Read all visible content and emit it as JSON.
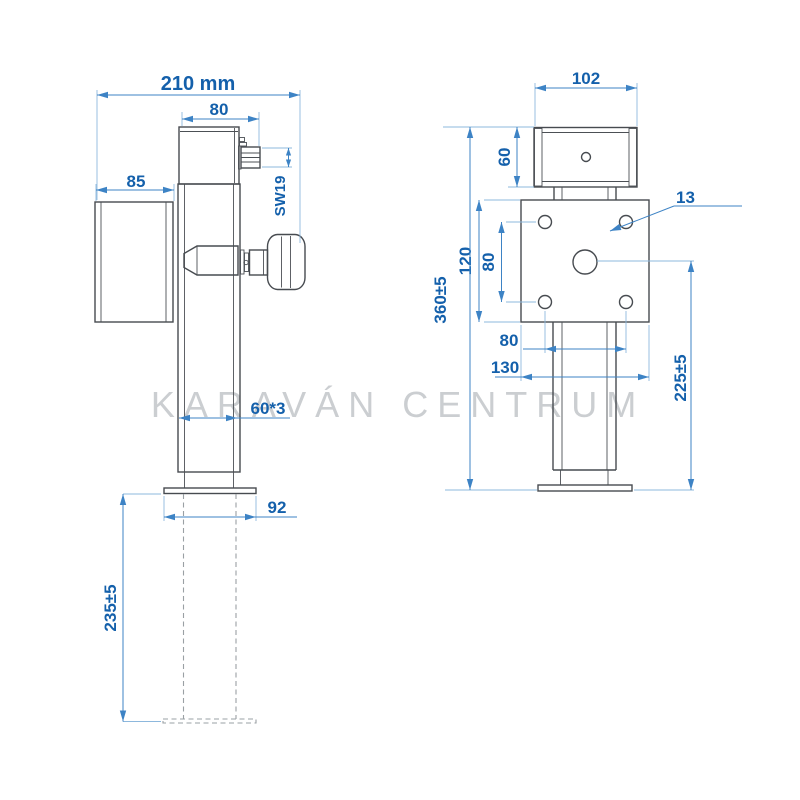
{
  "watermark": {
    "text": "KARAVÁN CENTRUM",
    "color": "#cbced1"
  },
  "colors": {
    "background": "#ffffff",
    "drawing_line": "#474b50",
    "hidden_line": "#9aa0a4",
    "dimension_line": "#3d83c5",
    "extension_line": "#8db8dd",
    "dimension_text": "#1460ab"
  },
  "views": {
    "side": {
      "dims": {
        "total_width": "210 mm",
        "gearbox_width": "80",
        "bracket_depth": "85",
        "hex_key": "SW19",
        "tube_section": "60*3",
        "flange_width": "92",
        "stroke_length": "235±5"
      }
    },
    "front": {
      "dims": {
        "gearbox_width": "102",
        "gearbox_height": "60",
        "hole_diameter": "13",
        "plate_height": "120",
        "hole_pitch_vertical": "80",
        "overall_height": "360±5",
        "hole_pitch_horizontal": "80",
        "plate_width": "130",
        "retracted_height": "225±5"
      }
    }
  }
}
